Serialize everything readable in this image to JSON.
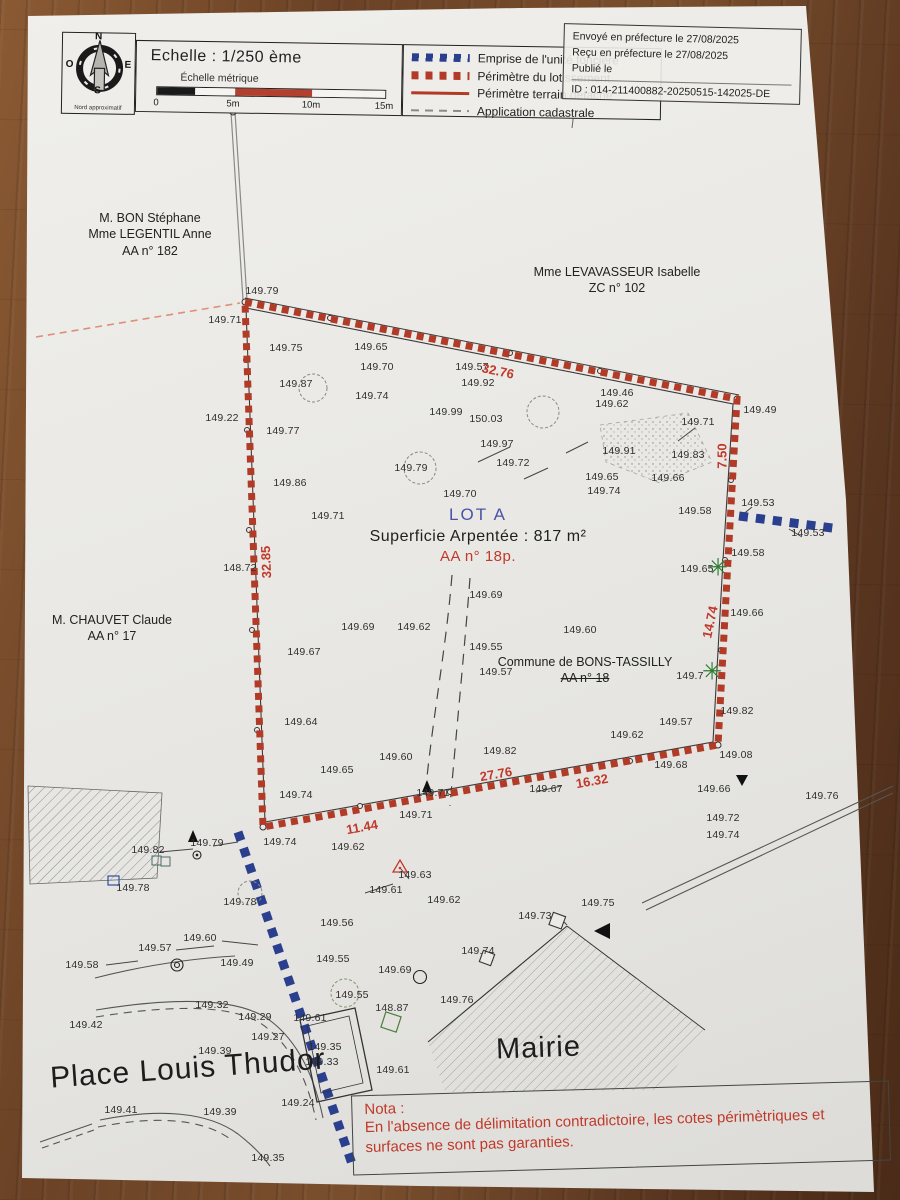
{
  "legend": {
    "scale_title": "Echelle : 1/250 ème",
    "scale_subtitle": "Échelle métrique",
    "scale_ticks": [
      "0",
      "5m",
      "10m",
      "15m"
    ],
    "scale_segments": [
      {
        "w": 38,
        "c": "#1a1a1a"
      },
      {
        "w": 40,
        "c": "#f5f4f0"
      },
      {
        "w": 77,
        "c": "#b3402e"
      },
      {
        "w": 73,
        "c": "#f5f4f0"
      }
    ],
    "north_label": "Nord approximatif",
    "compass": [
      "N",
      "E",
      "S",
      "O"
    ],
    "items": [
      {
        "label": "Emprise de l'unité foncière",
        "swatch": "sw-blue-dashed"
      },
      {
        "label": "Périmètre du lotissement",
        "swatch": "sw-red-dashed"
      },
      {
        "label": "Périmètre terrain détaché",
        "swatch": "sw-red-solid"
      },
      {
        "label": "Application cadastrale",
        "swatch": "sw-gray-dashed"
      }
    ]
  },
  "stamp": {
    "lines": [
      "Envoyé en préfecture le 27/08/2025",
      "Reçu en préfecture le 27/08/2025",
      "Publié le",
      "ID : 014-211400882-20250515-142025-DE"
    ]
  },
  "owners": [
    {
      "lines": [
        "M. BON Stéphane",
        "Mme LEGENTIL Anne",
        "AA n° 182"
      ],
      "x": 150,
      "y": 210,
      "strike_last": false
    },
    {
      "lines": [
        "Mme LEVAVASSEUR Isabelle",
        "ZC n° 102"
      ],
      "x": 617,
      "y": 264,
      "strike_last": false
    },
    {
      "lines": [
        "M. CHAUVET Claude",
        "AA n° 17"
      ],
      "x": 112,
      "y": 612,
      "strike_last": false
    },
    {
      "lines": [
        "Commune de BONS-TASSILLY",
        "AA n° 18"
      ],
      "x": 585,
      "y": 654,
      "strike_last": true
    }
  ],
  "lot": {
    "name": "LOT A",
    "area": "Superficie Arpentée : 817 m²",
    "ref": "AA n° 18p."
  },
  "places": [
    {
      "label": "Place Louis Thudor",
      "x": 50,
      "y": 1052,
      "size": 30,
      "rot": -4
    },
    {
      "label": "Mairie",
      "x": 496,
      "y": 1032,
      "size": 29,
      "rot": -2
    }
  ],
  "nota": {
    "title": "Nota :",
    "line1": "En l'absence de délimitation contradictoire, les cotes périmètriques et",
    "line2": "surfaces ne sont pas garanties."
  },
  "dims": [
    {
      "v": "32.76",
      "x": 498,
      "y": 371,
      "r": 12
    },
    {
      "v": "7.50",
      "x": 722,
      "y": 456,
      "r": -90
    },
    {
      "v": "32.85",
      "x": 266,
      "y": 562,
      "r": -92
    },
    {
      "v": "14.74",
      "x": 710,
      "y": 622,
      "r": -78
    },
    {
      "v": "27.76",
      "x": 496,
      "y": 774,
      "r": -10
    },
    {
      "v": "16.32",
      "x": 592,
      "y": 781,
      "r": -10
    },
    {
      "v": "11.44",
      "x": 362,
      "y": 827,
      "r": -10
    }
  ],
  "trees": [
    {
      "x": 718,
      "y": 568
    },
    {
      "x": 712,
      "y": 672
    }
  ],
  "points": [
    {
      "v": "149.79",
      "x": 262,
      "y": 291
    },
    {
      "v": "149.71",
      "x": 225,
      "y": 320
    },
    {
      "v": "149.75",
      "x": 286,
      "y": 348
    },
    {
      "v": "149.65",
      "x": 371,
      "y": 347
    },
    {
      "v": "149.70",
      "x": 377,
      "y": 367
    },
    {
      "v": "149.57",
      "x": 472,
      "y": 367
    },
    {
      "v": "149.92",
      "x": 478,
      "y": 383
    },
    {
      "v": "149.87",
      "x": 296,
      "y": 384
    },
    {
      "v": "149.74",
      "x": 372,
      "y": 396
    },
    {
      "v": "149.99",
      "x": 446,
      "y": 412
    },
    {
      "v": "150.03",
      "x": 486,
      "y": 419
    },
    {
      "v": "149.22",
      "x": 222,
      "y": 418
    },
    {
      "v": "149.77",
      "x": 283,
      "y": 431
    },
    {
      "v": "149.46",
      "x": 617,
      "y": 393
    },
    {
      "v": "149.62",
      "x": 612,
      "y": 404
    },
    {
      "v": "149.71",
      "x": 698,
      "y": 422
    },
    {
      "v": "149.49",
      "x": 760,
      "y": 410
    },
    {
      "v": "149.97",
      "x": 497,
      "y": 444
    },
    {
      "v": "149.91",
      "x": 619,
      "y": 451
    },
    {
      "v": "149.83",
      "x": 688,
      "y": 455
    },
    {
      "v": "149.72",
      "x": 513,
      "y": 463
    },
    {
      "v": "149.65",
      "x": 602,
      "y": 477
    },
    {
      "v": "149.66",
      "x": 668,
      "y": 478
    },
    {
      "v": "149.86",
      "x": 290,
      "y": 483
    },
    {
      "v": "149.79",
      "x": 411,
      "y": 468
    },
    {
      "v": "149.70",
      "x": 460,
      "y": 494
    },
    {
      "v": "149.74",
      "x": 604,
      "y": 491
    },
    {
      "v": "149.71",
      "x": 328,
      "y": 516
    },
    {
      "v": "149.58",
      "x": 695,
      "y": 511
    },
    {
      "v": "149.53",
      "x": 758,
      "y": 503
    },
    {
      "v": "149.53",
      "x": 808,
      "y": 533
    },
    {
      "v": "149.58",
      "x": 748,
      "y": 553
    },
    {
      "v": "149.65",
      "x": 697,
      "y": 569
    },
    {
      "v": "148.72",
      "x": 240,
      "y": 568
    },
    {
      "v": "149.69",
      "x": 486,
      "y": 595
    },
    {
      "v": "149.66",
      "x": 747,
      "y": 613
    },
    {
      "v": "149.69",
      "x": 358,
      "y": 627
    },
    {
      "v": "149.62",
      "x": 414,
      "y": 627
    },
    {
      "v": "149.60",
      "x": 580,
      "y": 630
    },
    {
      "v": "149.55",
      "x": 486,
      "y": 647
    },
    {
      "v": "149.67",
      "x": 304,
      "y": 652
    },
    {
      "v": "149.57",
      "x": 496,
      "y": 672
    },
    {
      "v": "149.7",
      "x": 690,
      "y": 676
    },
    {
      "v": "149.82",
      "x": 737,
      "y": 711
    },
    {
      "v": "149.57",
      "x": 676,
      "y": 722
    },
    {
      "v": "149.64",
      "x": 301,
      "y": 722
    },
    {
      "v": "149.62",
      "x": 627,
      "y": 735
    },
    {
      "v": "149.08",
      "x": 736,
      "y": 755
    },
    {
      "v": "149.60",
      "x": 396,
      "y": 757
    },
    {
      "v": "149.82",
      "x": 500,
      "y": 751
    },
    {
      "v": "149.68",
      "x": 671,
      "y": 765
    },
    {
      "v": "149.65",
      "x": 337,
      "y": 770
    },
    {
      "v": "149.67",
      "x": 546,
      "y": 789
    },
    {
      "v": "149.66",
      "x": 714,
      "y": 789
    },
    {
      "v": "149.76",
      "x": 822,
      "y": 796
    },
    {
      "v": "149.74",
      "x": 296,
      "y": 795
    },
    {
      "v": "149.71",
      "x": 433,
      "y": 793
    },
    {
      "v": "149.71",
      "x": 416,
      "y": 815
    },
    {
      "v": "149.72",
      "x": 723,
      "y": 818
    },
    {
      "v": "149.74",
      "x": 723,
      "y": 835
    },
    {
      "v": "149.79",
      "x": 207,
      "y": 843
    },
    {
      "v": "149.74",
      "x": 280,
      "y": 842
    },
    {
      "v": "149.82",
      "x": 148,
      "y": 850
    },
    {
      "v": "149.62",
      "x": 348,
      "y": 847
    },
    {
      "v": "149.78",
      "x": 133,
      "y": 888
    },
    {
      "v": "149.63",
      "x": 415,
      "y": 875
    },
    {
      "v": "149.61",
      "x": 386,
      "y": 890
    },
    {
      "v": "149.78",
      "x": 240,
      "y": 902
    },
    {
      "v": "149.62",
      "x": 444,
      "y": 900
    },
    {
      "v": "149.73",
      "x": 535,
      "y": 916
    },
    {
      "v": "149.75",
      "x": 598,
      "y": 903
    },
    {
      "v": "149.56",
      "x": 337,
      "y": 923
    },
    {
      "v": "149.60",
      "x": 200,
      "y": 938
    },
    {
      "v": "149.57",
      "x": 155,
      "y": 948
    },
    {
      "v": "149.58",
      "x": 82,
      "y": 965
    },
    {
      "v": "149.49",
      "x": 237,
      "y": 963
    },
    {
      "v": "149.55",
      "x": 333,
      "y": 959
    },
    {
      "v": "149.69",
      "x": 395,
      "y": 970
    },
    {
      "v": "149.74",
      "x": 478,
      "y": 951
    },
    {
      "v": "149.32",
      "x": 212,
      "y": 1005
    },
    {
      "v": "149.29",
      "x": 255,
      "y": 1017
    },
    {
      "v": "149.61",
      "x": 310,
      "y": 1018
    },
    {
      "v": "149.27",
      "x": 268,
      "y": 1037
    },
    {
      "v": "149.42",
      "x": 86,
      "y": 1025
    },
    {
      "v": "149.39",
      "x": 215,
      "y": 1051
    },
    {
      "v": "149.35",
      "x": 325,
      "y": 1047
    },
    {
      "v": "149.33",
      "x": 322,
      "y": 1062
    },
    {
      "v": "149.24",
      "x": 298,
      "y": 1103
    },
    {
      "v": "149.41",
      "x": 121,
      "y": 1110
    },
    {
      "v": "149.39",
      "x": 220,
      "y": 1112
    },
    {
      "v": "149.35",
      "x": 268,
      "y": 1158
    },
    {
      "v": "149.55",
      "x": 352,
      "y": 995
    },
    {
      "v": "148.87",
      "x": 392,
      "y": 1008
    },
    {
      "v": "149.76",
      "x": 457,
      "y": 1000
    },
    {
      "v": "149.61",
      "x": 393,
      "y": 1070
    }
  ],
  "colors": {
    "boundary_red": "#b23b28",
    "line_blue": "#2a3f8e",
    "label_red": "#c0392b",
    "lot_blue": "#4a52a8"
  }
}
